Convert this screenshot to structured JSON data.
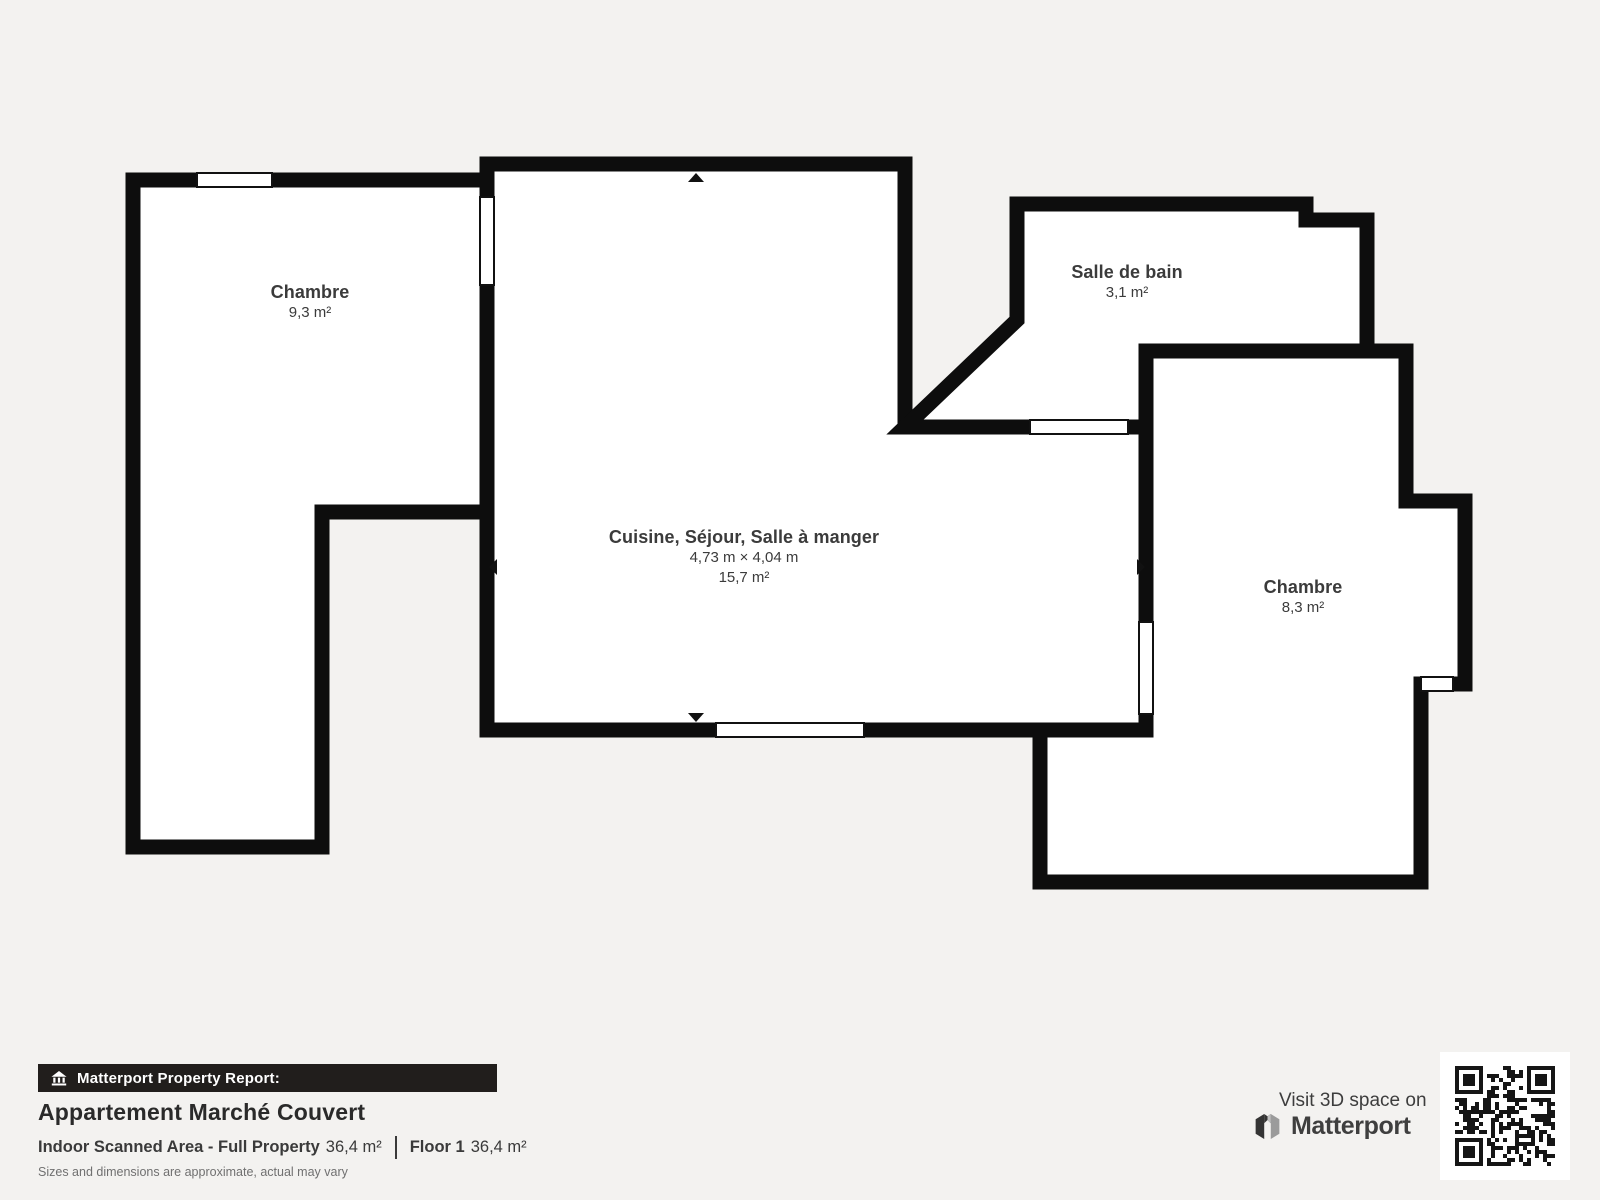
{
  "floor_plan": {
    "rooms": [
      {
        "name": "Chambre",
        "area": "9,3 m²"
      },
      {
        "name": "Cuisine, Séjour, Salle à manger",
        "dimensions": "4,73 m × 4,04 m",
        "area": "15,7 m²"
      },
      {
        "name": "Salle de bain",
        "area": "3,1 m²"
      },
      {
        "name": "Chambre",
        "area": "8,3 m²"
      }
    ]
  },
  "report": {
    "badge_label": "Matterport Property Report:",
    "property_name": "Appartement Marché Couvert",
    "area_label": "Indoor Scanned Area - Full Property",
    "area_value": "36,4 m²",
    "floor_label": "Floor 1",
    "floor_value": "36,4 m²",
    "disclaimer": "Sizes and dimensions are approximate, actual may vary"
  },
  "footer_cta": {
    "visit_label": "Visit 3D space on",
    "brand_name": "Matterport"
  },
  "colors": {
    "background": "#f3f2f0",
    "wall": "#0d0d0d",
    "room_fill": "#ffffff",
    "label_text": "#3b3b3b",
    "badge_background": "#211e1c",
    "badge_text": "#ffffff"
  }
}
